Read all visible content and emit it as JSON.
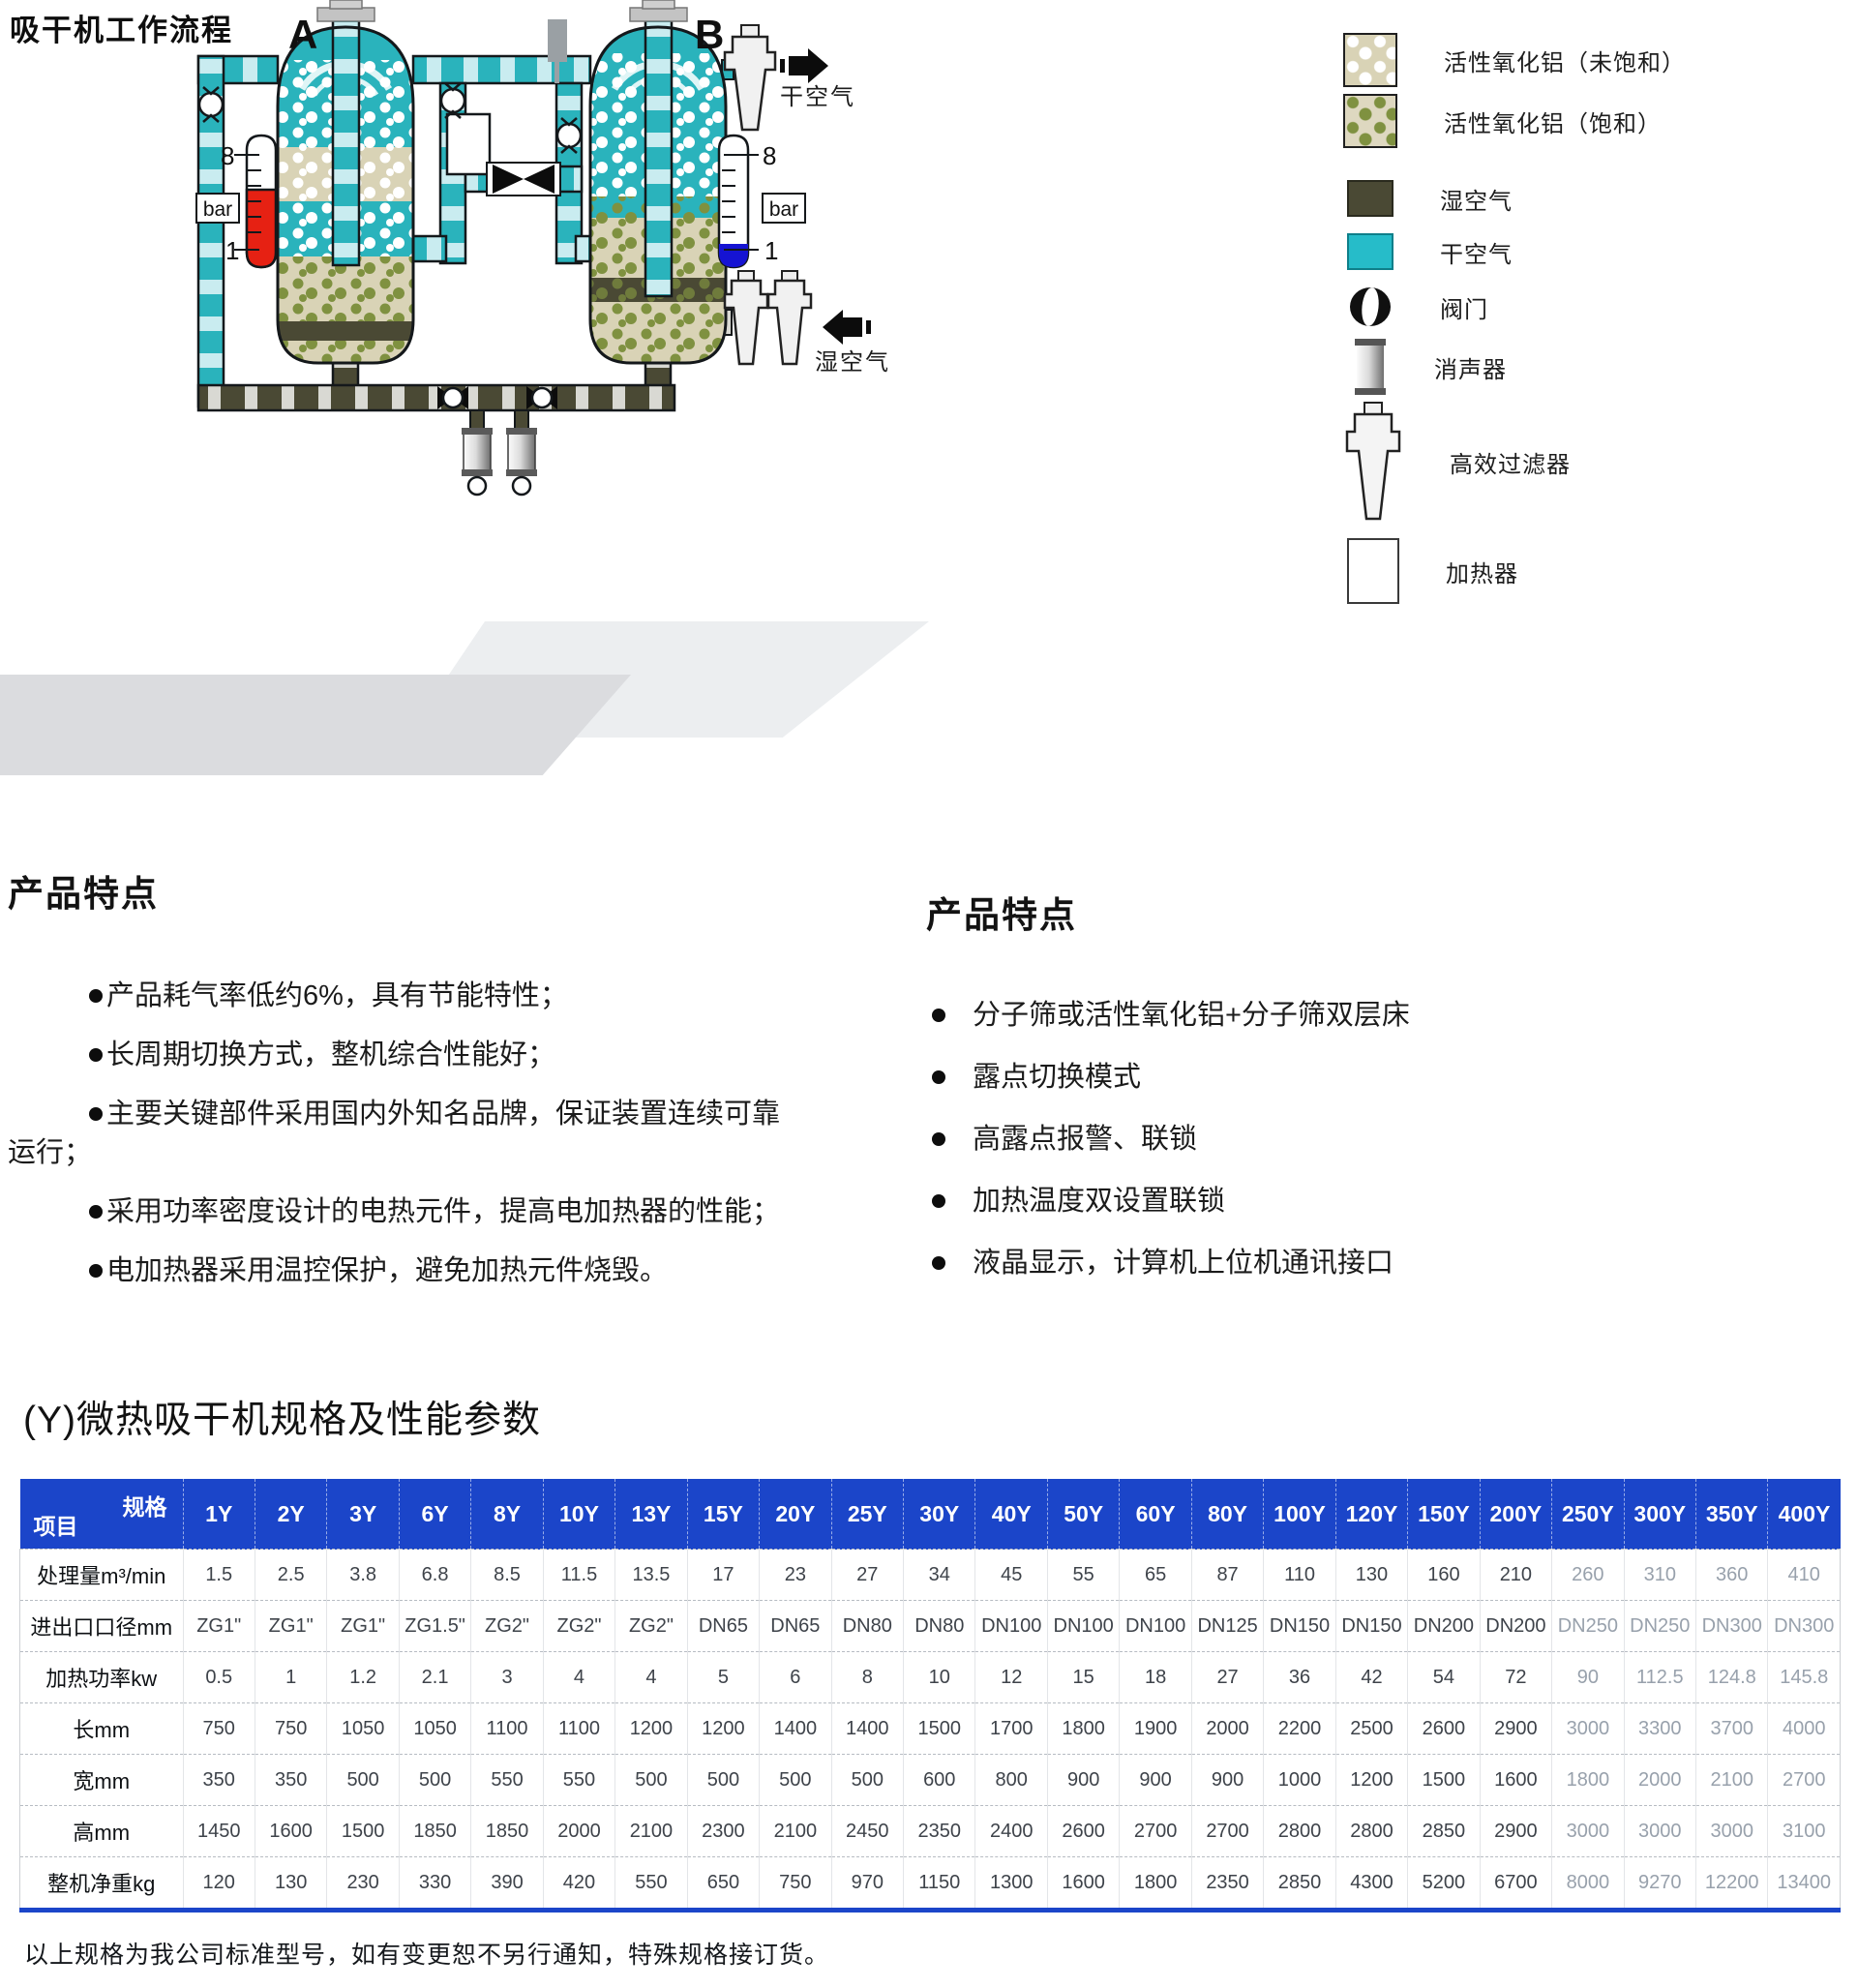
{
  "diagram": {
    "title": "吸干机工作流程",
    "tower_a_label": "A",
    "tower_b_label": "B",
    "gauge": {
      "unit": "bar",
      "max": "8",
      "min": "1"
    },
    "dry_air_label": "干空气",
    "wet_air_label": "湿空气",
    "legend": [
      {
        "name": "alumina-unsaturated",
        "label": "活性氧化铝（未饱和）"
      },
      {
        "name": "alumina-saturated",
        "label": "活性氧化铝（饱和）"
      },
      {
        "name": "wet-air",
        "label": "湿空气",
        "color": "#4a4934"
      },
      {
        "name": "dry-air",
        "label": "干空气",
        "color": "#26bcc9"
      },
      {
        "name": "valve",
        "label": "阀门"
      },
      {
        "name": "muffler",
        "label": "消声器"
      },
      {
        "name": "hepa-filter",
        "label": "高效过滤器"
      },
      {
        "name": "heater",
        "label": "加热器"
      }
    ]
  },
  "features_left": {
    "heading": "产品特点",
    "items": [
      "产品耗气率低约6%，具有节能特性；",
      "长周期切换方式，整机综合性能好；",
      "主要关键部件采用国内外知名品牌，保证装置连续可靠运行；",
      "采用功率密度设计的电热元件，提高电加热器的性能；",
      "电加热器采用温控保护，避免加热元件烧毁。"
    ]
  },
  "features_right": {
    "heading": "产品特点",
    "items": [
      "分子筛或活性氧化铝+分子筛双层床",
      "露点切换模式",
      "高露点报警、联锁",
      "加热温度双设置联锁",
      "液晶显示，计算机上位机通讯接口"
    ]
  },
  "table": {
    "title": "(Y)微热吸干机规格及性能参数",
    "corner": {
      "top": "规格",
      "bottom": "项目"
    },
    "columns": [
      "1Y",
      "2Y",
      "3Y",
      "6Y",
      "8Y",
      "10Y",
      "13Y",
      "15Y",
      "20Y",
      "25Y",
      "30Y",
      "40Y",
      "50Y",
      "60Y",
      "80Y",
      "100Y",
      "120Y",
      "150Y",
      "200Y",
      "250Y",
      "300Y",
      "350Y",
      "400Y"
    ],
    "rows": [
      {
        "label": "处理量m³/min",
        "values": [
          "1.5",
          "2.5",
          "3.8",
          "6.8",
          "8.5",
          "11.5",
          "13.5",
          "17",
          "23",
          "27",
          "34",
          "45",
          "55",
          "65",
          "87",
          "110",
          "130",
          "160",
          "210",
          "260",
          "310",
          "360",
          "410"
        ]
      },
      {
        "label": "进出口口径mm",
        "values": [
          "ZG1\"",
          "ZG1\"",
          "ZG1\"",
          "ZG1.5\"",
          "ZG2\"",
          "ZG2\"",
          "ZG2\"",
          "DN65",
          "DN65",
          "DN80",
          "DN80",
          "DN100",
          "DN100",
          "DN100",
          "DN125",
          "DN150",
          "DN150",
          "DN200",
          "DN200",
          "DN250",
          "DN250",
          "DN300",
          "DN300"
        ]
      },
      {
        "label": "加热功率kw",
        "values": [
          "0.5",
          "1",
          "1.2",
          "2.1",
          "3",
          "4",
          "4",
          "5",
          "6",
          "8",
          "10",
          "12",
          "15",
          "18",
          "27",
          "36",
          "42",
          "54",
          "72",
          "90",
          "112.5",
          "124.8",
          "145.8"
        ]
      },
      {
        "label": "长mm",
        "values": [
          "750",
          "750",
          "1050",
          "1050",
          "1100",
          "1100",
          "1200",
          "1200",
          "1400",
          "1400",
          "1500",
          "1700",
          "1800",
          "1900",
          "2000",
          "2200",
          "2500",
          "2600",
          "2900",
          "3000",
          "3300",
          "3700",
          "4000"
        ]
      },
      {
        "label": "宽mm",
        "values": [
          "350",
          "350",
          "500",
          "500",
          "550",
          "550",
          "500",
          "500",
          "500",
          "500",
          "600",
          "800",
          "900",
          "900",
          "900",
          "1000",
          "1200",
          "1500",
          "1600",
          "1800",
          "2000",
          "2100",
          "2700"
        ]
      },
      {
        "label": "高mm",
        "values": [
          "1450",
          "1600",
          "1500",
          "1850",
          "1850",
          "2000",
          "2100",
          "2300",
          "2100",
          "2450",
          "2350",
          "2400",
          "2600",
          "2700",
          "2700",
          "2800",
          "2800",
          "2850",
          "2900",
          "3000",
          "3000",
          "3000",
          "3100"
        ]
      },
      {
        "label": "整机净重kg",
        "values": [
          "120",
          "130",
          "230",
          "330",
          "390",
          "420",
          "550",
          "650",
          "750",
          "970",
          "1150",
          "1300",
          "1600",
          "1800",
          "2350",
          "2850",
          "4300",
          "5200",
          "6700",
          "8000",
          "9270",
          "12200",
          "13400"
        ]
      }
    ],
    "footnote": "以上规格为我公司标准型号，如有变更恕不另行通知，特殊规格接订货。"
  },
  "colors": {
    "header_blue": "#1b45c9",
    "dry_air_teal": "#2ab3bc",
    "wet_air_olive": "#4a4934",
    "gauge_red": "#e62113",
    "gauge_blue": "#1513d2"
  }
}
